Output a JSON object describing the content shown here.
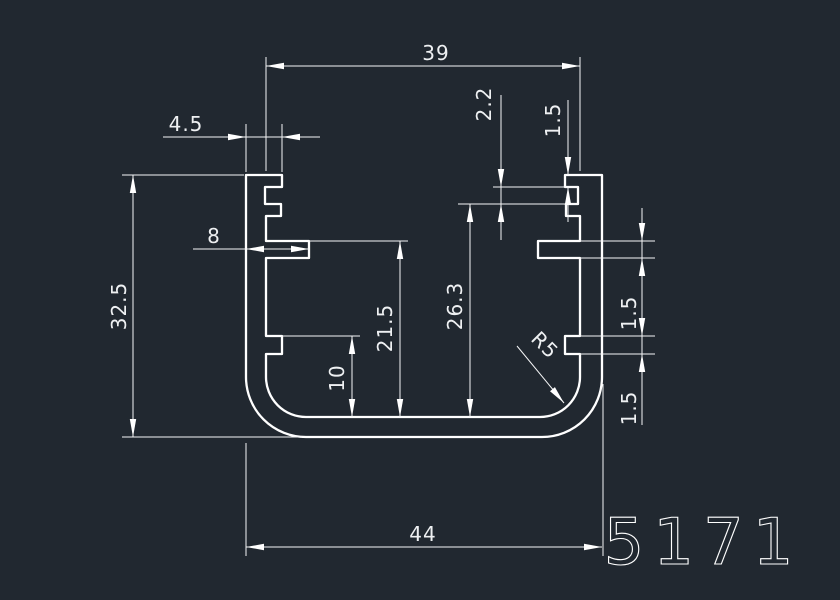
{
  "drawing": {
    "part_number": "5171",
    "colors": {
      "background": "#212830",
      "line": "#ffffff"
    },
    "dimensions": {
      "inner_width_top": "39",
      "lip_width": "4.5",
      "groove_height": "2.2",
      "tooth_height": "1.5",
      "overall_height": "32.5",
      "flange_length": "8",
      "flange_top_to_floor": "21.5",
      "seat_to_floor": "26.3",
      "rib_to_floor": "10",
      "flange_thickness": "1.5",
      "rib_height": "1.5",
      "corner_radius": "R5",
      "overall_width": "44"
    }
  }
}
